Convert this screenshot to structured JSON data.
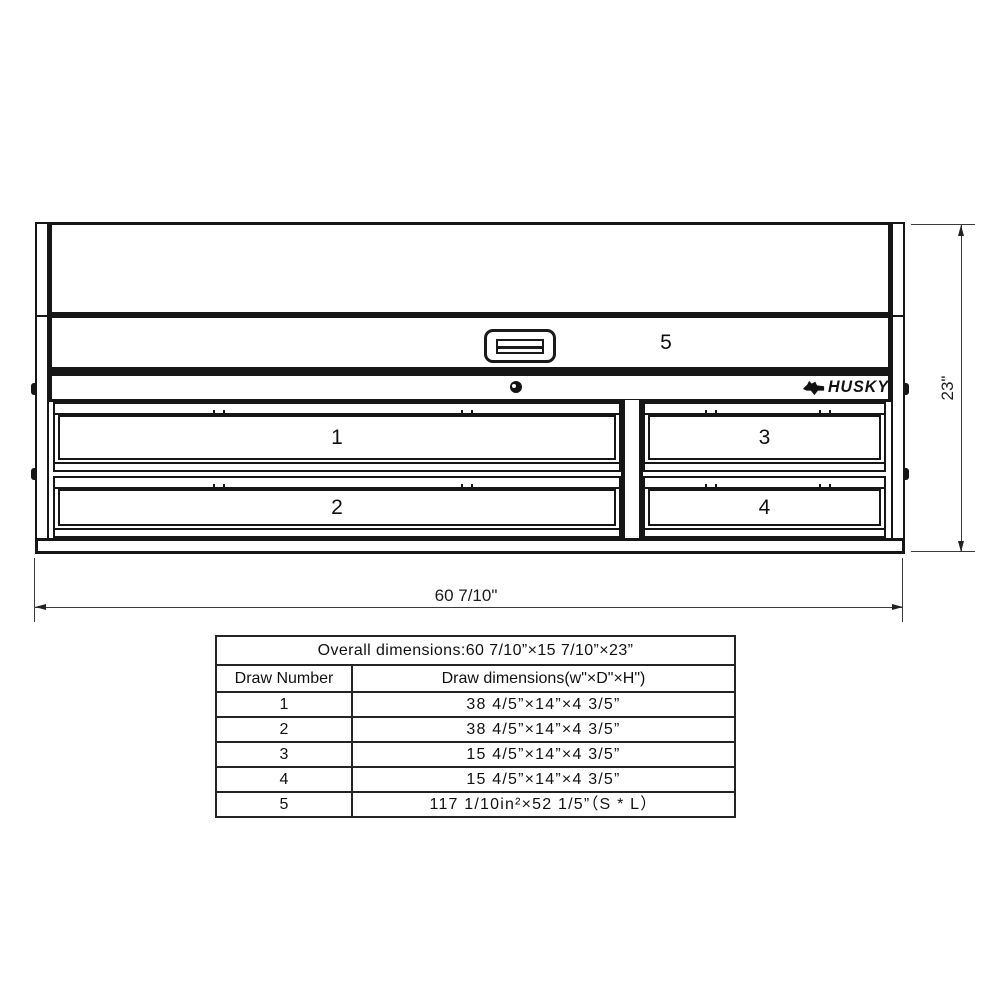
{
  "drawing": {
    "brand": "HUSKY",
    "drawers": [
      {
        "label": "1"
      },
      {
        "label": "2"
      },
      {
        "label": "3"
      },
      {
        "label": "4"
      },
      {
        "label": "5"
      }
    ],
    "width_dim": "60 7/10\"",
    "height_dim": "23\"",
    "line_color": "#161616"
  },
  "table": {
    "overall_header": "Overall dimensions:60 7/10”×15 7/10”×23”",
    "columns": [
      "Draw Number",
      "Draw dimensions(w\"×D\"×H\")"
    ],
    "rows": [
      {
        "num": "1",
        "dims": "38 4/5”×14”×4 3/5”"
      },
      {
        "num": "2",
        "dims": "38 4/5”×14”×4 3/5”"
      },
      {
        "num": "3",
        "dims": "15 4/5”×14”×4 3/5”"
      },
      {
        "num": "4",
        "dims": "15 4/5”×14”×4 3/5”"
      },
      {
        "num": "5",
        "dims": "117 1/10in²×52 1/5”（S * L）"
      }
    ]
  }
}
